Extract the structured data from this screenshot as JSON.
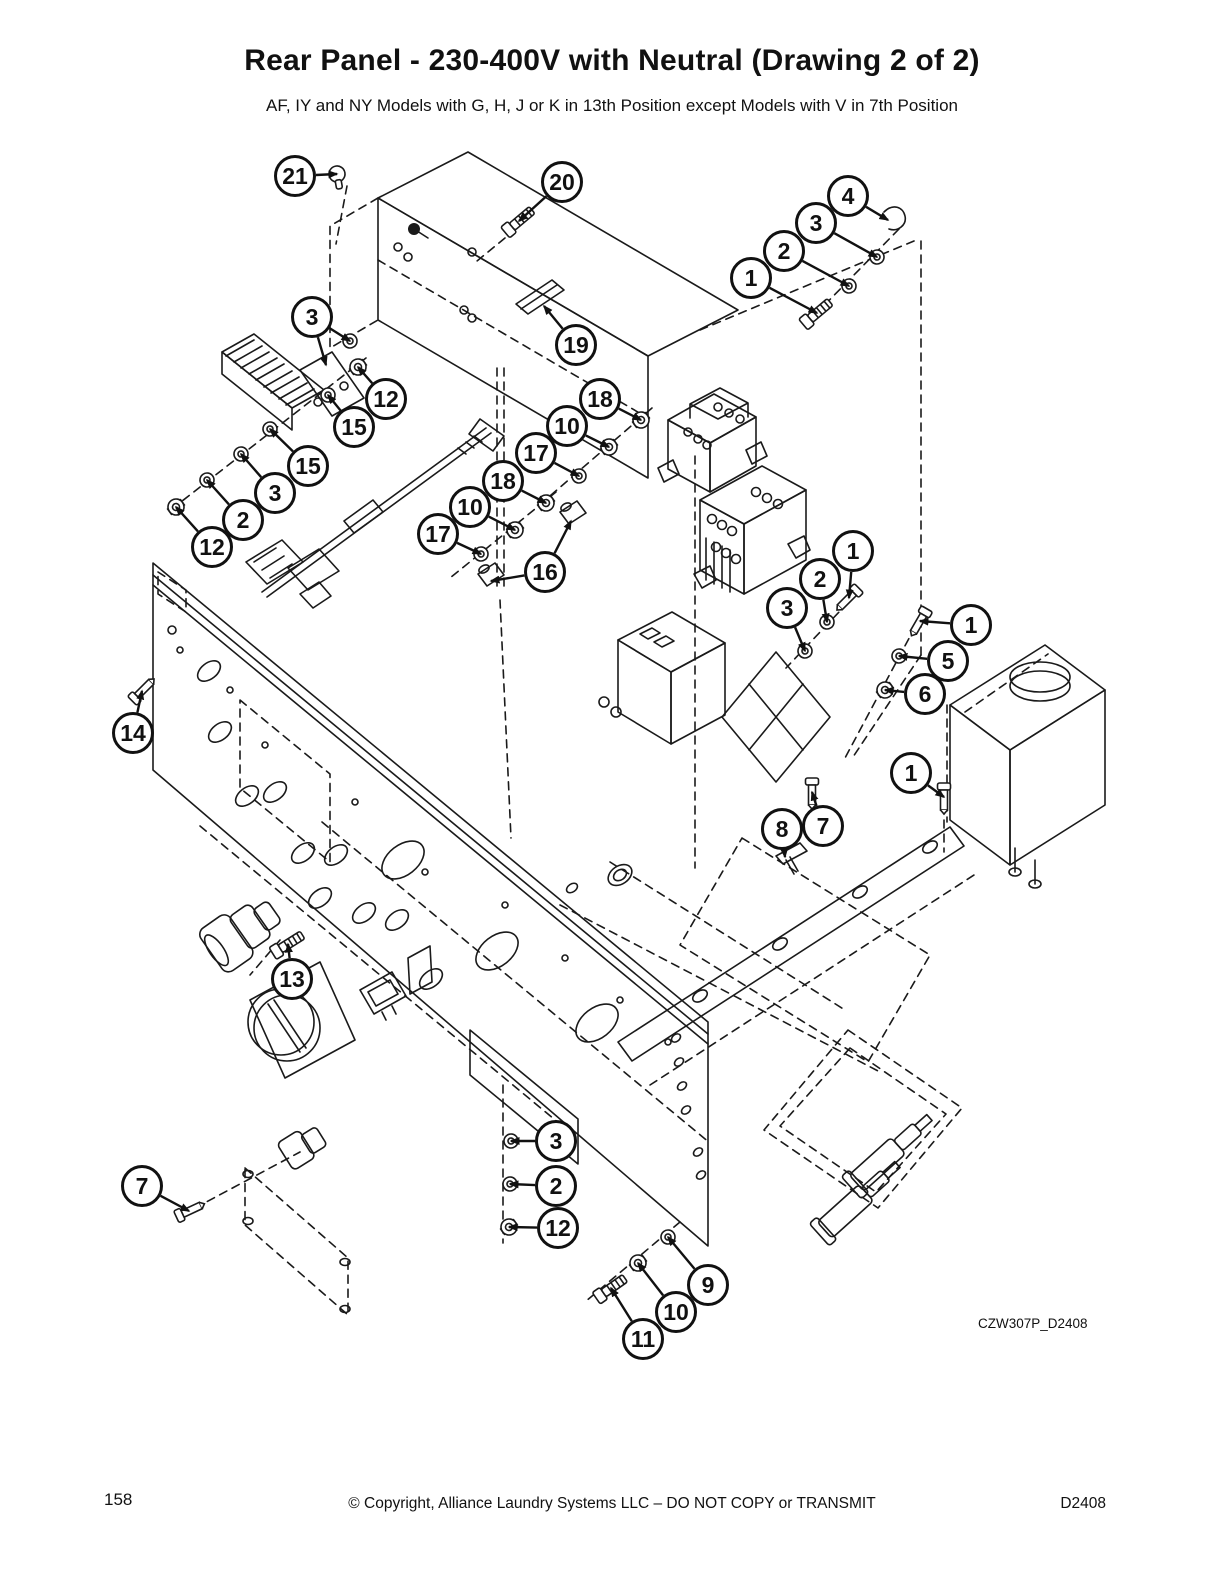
{
  "page": {
    "title": "Rear Panel - 230-400V with Neutral (Drawing 2 of 2)",
    "subtitle": "AF, IY and NY Models with G, H, J or K in 13th Position except Models with V in 7th Position",
    "diagram_code": "CZW307P_D2408",
    "footer": {
      "page_number": "158",
      "copyright": "© Copyright, Alliance Laundry Systems LLC – DO NOT COPY or TRANSMIT",
      "doc_code": "D2408"
    },
    "ink_color": "#1a1a1a"
  },
  "callouts": [
    {
      "label": "21",
      "x": 295,
      "y": 176,
      "targets": [
        [
          337,
          174
        ]
      ],
      "glyph": "screw-head",
      "rot": 80
    },
    {
      "label": "20",
      "x": 562,
      "y": 182,
      "targets": [
        [
          519,
          221
        ]
      ],
      "glyph": "bolt",
      "rot": -40
    },
    {
      "label": "19",
      "x": 576,
      "y": 345,
      "targets": [
        [
          544,
          306
        ]
      ],
      "glyph": "none"
    },
    {
      "label": "3",
      "x": 312,
      "y": 317,
      "targets": [
        [
          350,
          341
        ],
        [
          326,
          365
        ]
      ],
      "glyph": "washer"
    },
    {
      "label": "12",
      "x": 386,
      "y": 399,
      "targets": [
        [
          358,
          367
        ]
      ],
      "glyph": "nut"
    },
    {
      "label": "15",
      "x": 354,
      "y": 427,
      "targets": [
        [
          328,
          395
        ]
      ],
      "glyph": "washer"
    },
    {
      "label": "15",
      "x": 308,
      "y": 466,
      "targets": [
        [
          270,
          429
        ]
      ],
      "glyph": "washer"
    },
    {
      "label": "3",
      "x": 275,
      "y": 493,
      "targets": [
        [
          241,
          454
        ]
      ],
      "glyph": "washer"
    },
    {
      "label": "2",
      "x": 243,
      "y": 520,
      "targets": [
        [
          207,
          480
        ]
      ],
      "glyph": "washer"
    },
    {
      "label": "12",
      "x": 212,
      "y": 547,
      "targets": [
        [
          176,
          507
        ]
      ],
      "glyph": "nut"
    },
    {
      "label": "4",
      "x": 848,
      "y": 196,
      "targets": [
        [
          888,
          220
        ]
      ],
      "glyph": "none"
    },
    {
      "label": "3",
      "x": 816,
      "y": 223,
      "targets": [
        [
          877,
          257
        ]
      ],
      "glyph": "washer"
    },
    {
      "label": "2",
      "x": 784,
      "y": 251,
      "targets": [
        [
          849,
          286
        ]
      ],
      "glyph": "washer"
    },
    {
      "label": "1",
      "x": 751,
      "y": 278,
      "targets": [
        [
          817,
          313
        ]
      ],
      "glyph": "bolt",
      "rot": -40
    },
    {
      "label": "18",
      "x": 600,
      "y": 399,
      "targets": [
        [
          641,
          420
        ]
      ],
      "glyph": "nut"
    },
    {
      "label": "10",
      "x": 567,
      "y": 426,
      "targets": [
        [
          609,
          447
        ]
      ],
      "glyph": "nut"
    },
    {
      "label": "17",
      "x": 536,
      "y": 453,
      "targets": [
        [
          579,
          476
        ]
      ],
      "glyph": "washer"
    },
    {
      "label": "18",
      "x": 503,
      "y": 481,
      "targets": [
        [
          546,
          503
        ]
      ],
      "glyph": "nut"
    },
    {
      "label": "10",
      "x": 470,
      "y": 507,
      "targets": [
        [
          515,
          530
        ]
      ],
      "glyph": "nut"
    },
    {
      "label": "17",
      "x": 438,
      "y": 534,
      "targets": [
        [
          481,
          554
        ]
      ],
      "glyph": "washer"
    },
    {
      "label": "16",
      "x": 545,
      "y": 572,
      "targets": [
        [
          571,
          521
        ],
        [
          491,
          581
        ]
      ],
      "glyph": "none"
    },
    {
      "label": "1",
      "x": 853,
      "y": 551,
      "targets": [
        [
          849,
          598
        ]
      ],
      "glyph": "screw",
      "rot": 135
    },
    {
      "label": "2",
      "x": 820,
      "y": 579,
      "targets": [
        [
          827,
          622
        ]
      ],
      "glyph": "washer"
    },
    {
      "label": "3",
      "x": 787,
      "y": 608,
      "targets": [
        [
          805,
          651
        ]
      ],
      "glyph": "washer"
    },
    {
      "label": "1",
      "x": 971,
      "y": 625,
      "targets": [
        [
          920,
          621
        ]
      ],
      "glyph": "screw",
      "rot": 120
    },
    {
      "label": "5",
      "x": 948,
      "y": 661,
      "targets": [
        [
          899,
          656
        ]
      ],
      "glyph": "washer"
    },
    {
      "label": "6",
      "x": 925,
      "y": 694,
      "targets": [
        [
          885,
          690
        ]
      ],
      "glyph": "nut"
    },
    {
      "label": "1",
      "x": 911,
      "y": 773,
      "targets": [
        [
          944,
          797
        ]
      ],
      "glyph": "screw",
      "rot": 90
    },
    {
      "label": "7",
      "x": 823,
      "y": 826,
      "targets": [
        [
          812,
          792
        ]
      ],
      "glyph": "screw",
      "rot": 90
    },
    {
      "label": "8",
      "x": 782,
      "y": 829,
      "targets": [
        [
          785,
          857
        ]
      ],
      "glyph": "none"
    },
    {
      "label": "14",
      "x": 133,
      "y": 733,
      "targets": [
        [
          142,
          691
        ]
      ],
      "glyph": "screw",
      "rot": -45
    },
    {
      "label": "13",
      "x": 292,
      "y": 979,
      "targets": [
        [
          288,
          944
        ]
      ],
      "glyph": "bolt",
      "rot": -32
    },
    {
      "label": "7",
      "x": 142,
      "y": 1186,
      "targets": [
        [
          189,
          1211
        ]
      ],
      "glyph": "screw",
      "rot": -25
    },
    {
      "label": "3",
      "x": 556,
      "y": 1141,
      "targets": [
        [
          511,
          1141
        ]
      ],
      "glyph": "washer"
    },
    {
      "label": "2",
      "x": 556,
      "y": 1186,
      "targets": [
        [
          510,
          1184
        ]
      ],
      "glyph": "washer"
    },
    {
      "label": "12",
      "x": 558,
      "y": 1228,
      "targets": [
        [
          509,
          1227
        ]
      ],
      "glyph": "nut"
    },
    {
      "label": "9",
      "x": 708,
      "y": 1285,
      "targets": [
        [
          668,
          1237
        ]
      ],
      "glyph": "washer"
    },
    {
      "label": "10",
      "x": 676,
      "y": 1312,
      "targets": [
        [
          638,
          1263
        ]
      ],
      "glyph": "nut"
    },
    {
      "label": "11",
      "x": 643,
      "y": 1339,
      "targets": [
        [
          611,
          1288
        ]
      ],
      "glyph": "bolt",
      "rot": -35
    }
  ]
}
